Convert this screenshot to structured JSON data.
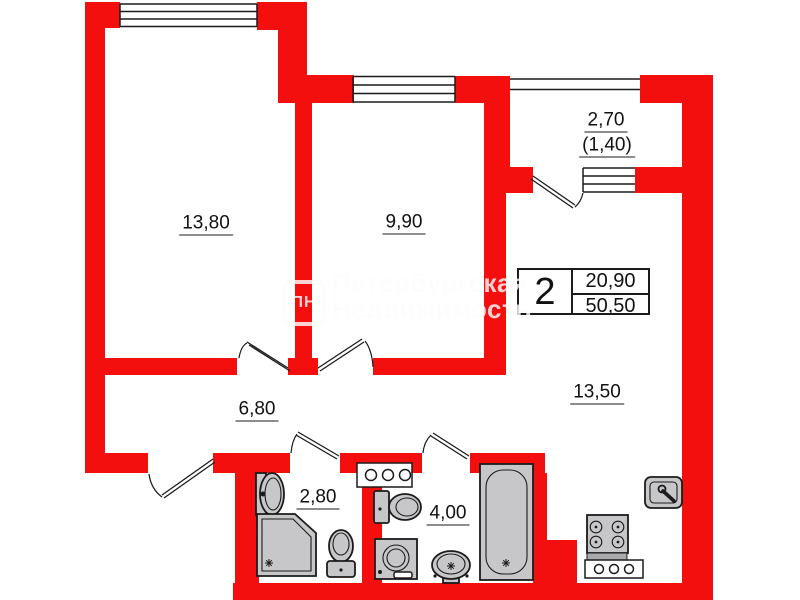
{
  "colors": {
    "wall": "#f40f0f",
    "fixture": "#c7c7c9",
    "line": "#1b1b1b",
    "label": "#111111",
    "watermark": "rgba(252,252,252,0.82)"
  },
  "rooms": [
    {
      "name": "room-1",
      "area": "13,80"
    },
    {
      "name": "room-2",
      "area": "9,90"
    },
    {
      "name": "balcony",
      "area": "2,70",
      "area_reduced": "(1,40)"
    },
    {
      "name": "hallway",
      "area": "6,80"
    },
    {
      "name": "bathroom",
      "area": "2,80"
    },
    {
      "name": "wc",
      "area": "4,00"
    },
    {
      "name": "kitchen-living",
      "area": "13,50"
    }
  ],
  "info_box": {
    "room_count": "2",
    "living_area": "20,90",
    "total_area": "50,50"
  },
  "watermark": {
    "logo": "ПН",
    "line1": "Петербургская",
    "line2": "Недвижимость"
  }
}
